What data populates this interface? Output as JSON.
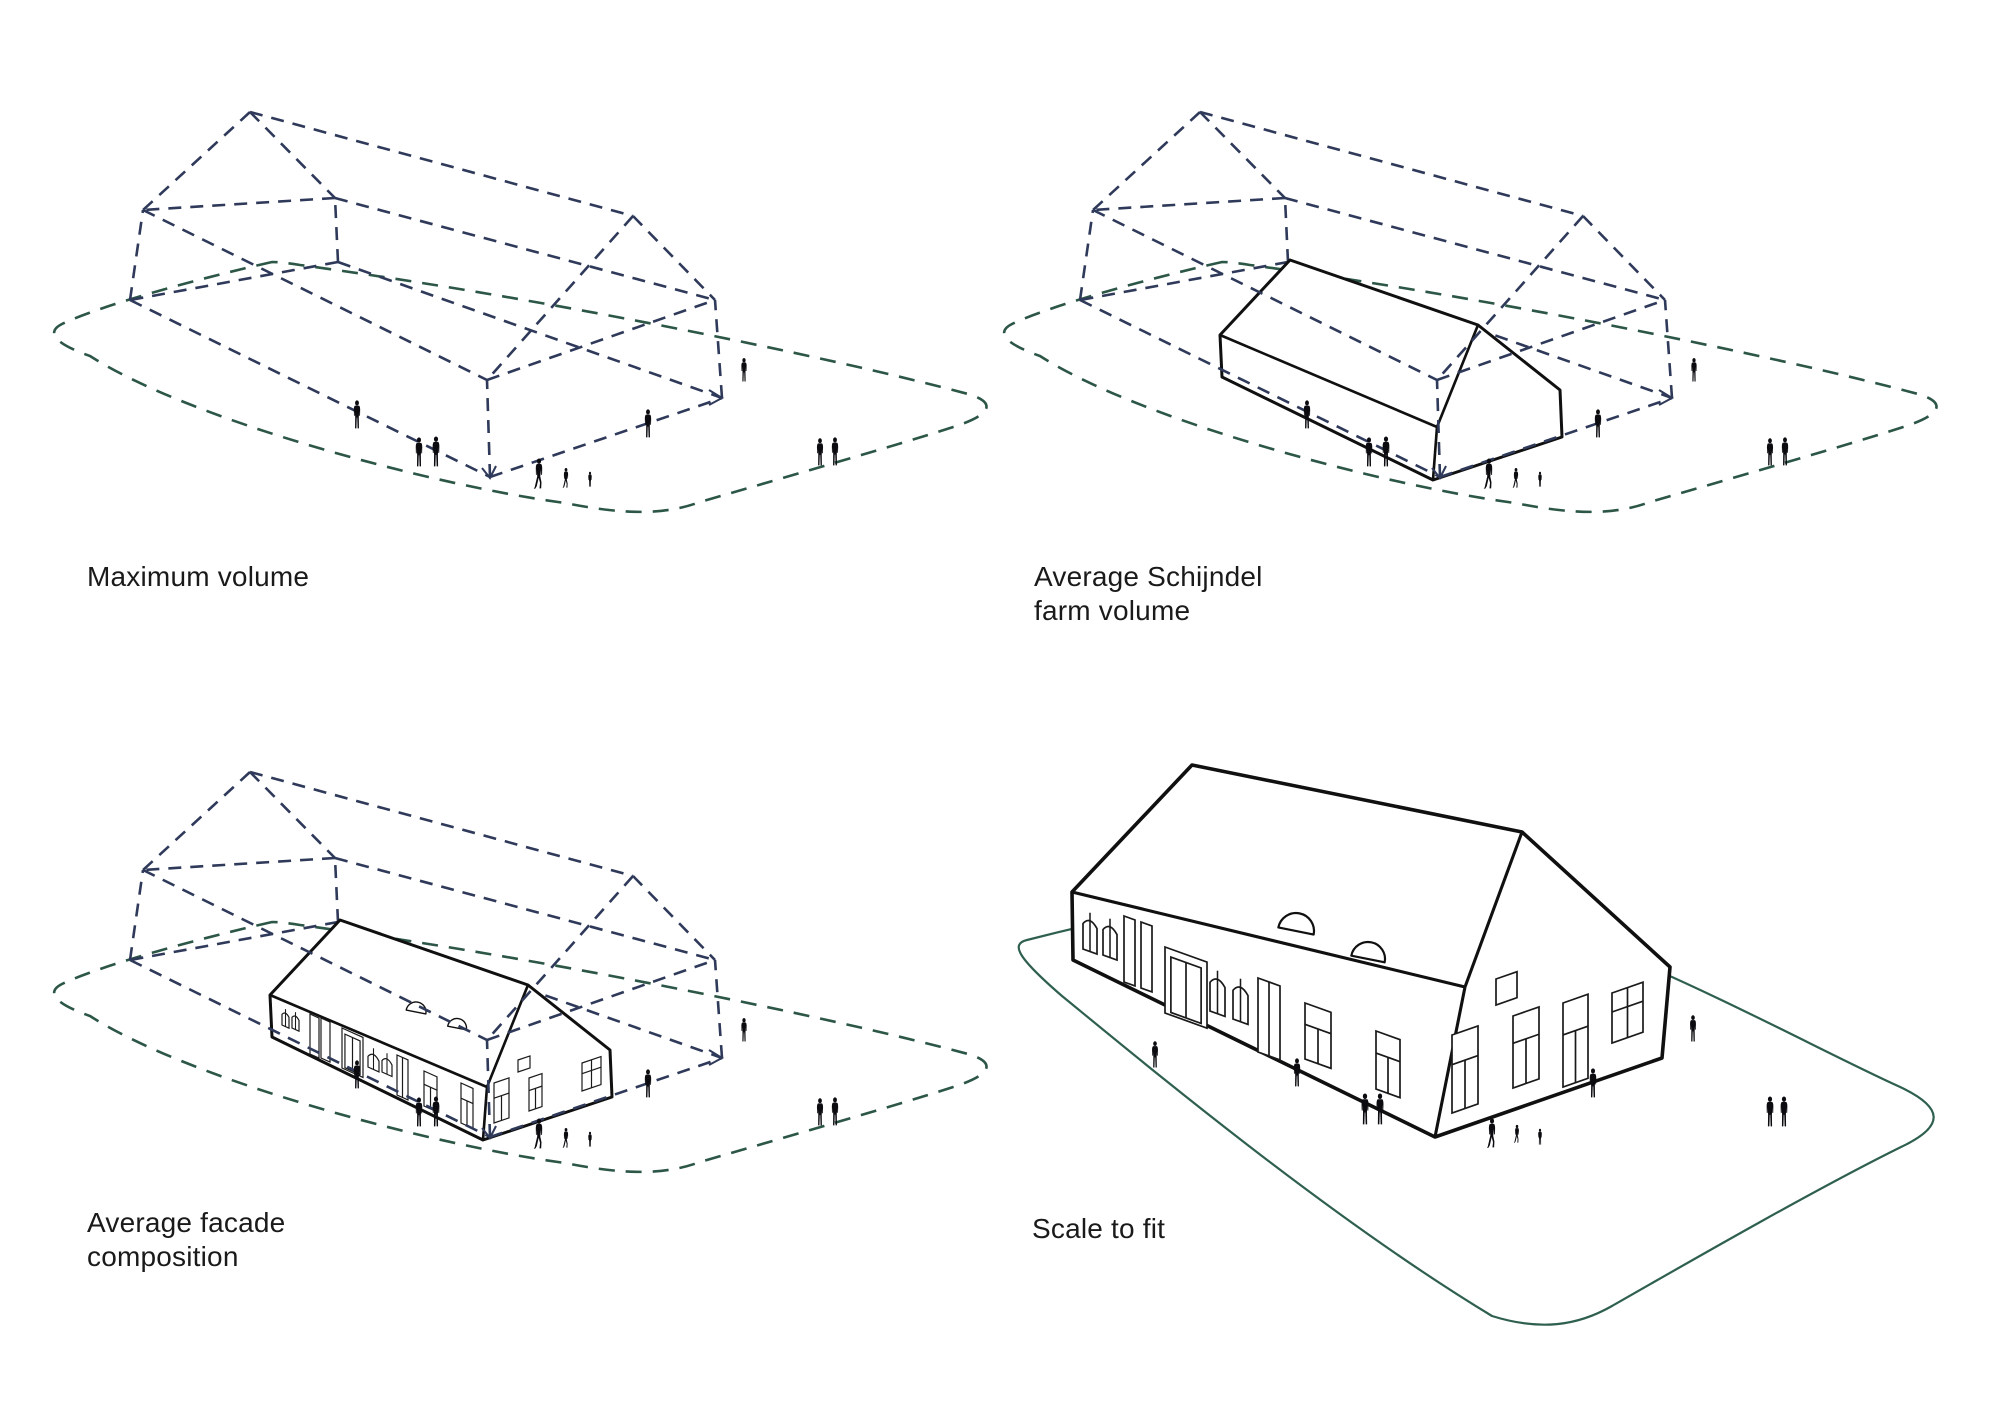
{
  "page_title": "Farm volume massing study diagrams",
  "panels": [
    {
      "id": "maximum-volume",
      "label_lines": [
        "Maximum volume"
      ],
      "building": "none",
      "volume_wireframe": true,
      "plot_outline": "dashed"
    },
    {
      "id": "average-schijndel-farm-volume",
      "label_lines": [
        "Average Schijndel",
        "farm volume"
      ],
      "building": "plain-massing",
      "volume_wireframe": true,
      "plot_outline": "dashed"
    },
    {
      "id": "average-facade-composition",
      "label_lines": [
        "Average facade",
        "composition"
      ],
      "building": "detailed-small",
      "volume_wireframe": true,
      "plot_outline": "dashed"
    },
    {
      "id": "scale-to-fit",
      "label_lines": [
        "Scale to fit"
      ],
      "building": "detailed-large",
      "volume_wireframe": false,
      "plot_outline": "solid"
    }
  ],
  "colors": {
    "volume_dash": "#2f3a5a",
    "plot_dash": "#2c5646",
    "plot_solid": "#2f604f",
    "building_ink": "#101010",
    "detail_ink": "#1a1a1a",
    "people": "#0b0b10",
    "label_text": "#1a1a1a",
    "background": "#ffffff"
  }
}
